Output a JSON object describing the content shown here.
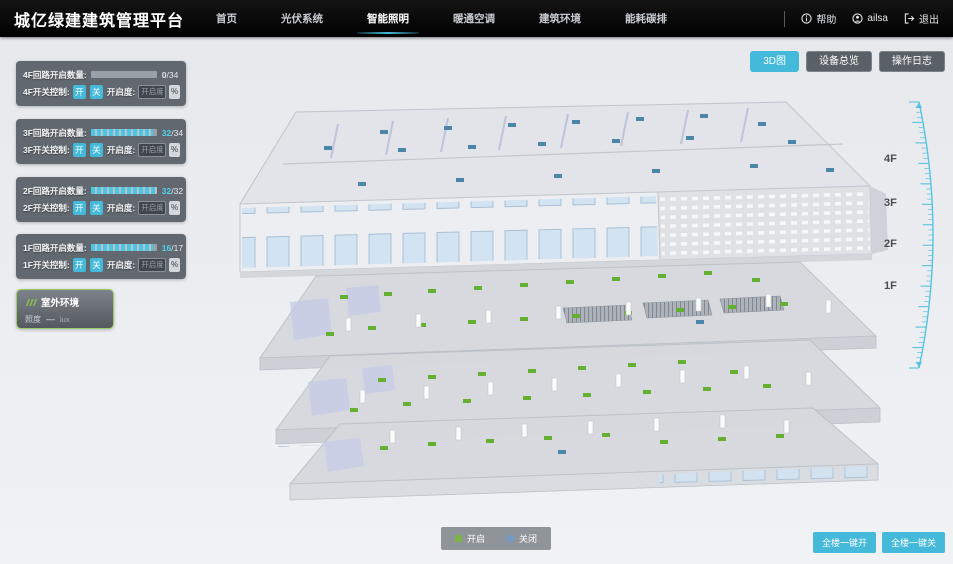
{
  "header": {
    "title": "城亿绿建建筑管理平台",
    "nav": [
      {
        "label": "首页",
        "active": false
      },
      {
        "label": "光伏系统",
        "active": false
      },
      {
        "label": "智能照明",
        "active": true
      },
      {
        "label": "暖通空调",
        "active": false
      },
      {
        "label": "建筑环境",
        "active": false
      },
      {
        "label": "能耗碳排",
        "active": false
      }
    ],
    "user": {
      "help_label": "帮助",
      "username": "ailsa",
      "logout_label": "退出"
    }
  },
  "view_buttons": [
    {
      "label": "3D图",
      "active": true
    },
    {
      "label": "设备总览",
      "active": false
    },
    {
      "label": "操作日志",
      "active": false
    }
  ],
  "floor_panels": [
    {
      "floor": "4F",
      "count_label": "4F回路开启数量:",
      "open": "0",
      "total": "/34",
      "percent": 0,
      "switch_label": "4F开关控制:",
      "on_label": "开",
      "off_label": "关",
      "dim_label": "开启度:",
      "dim_placeholder": "开启度",
      "unit": "%"
    },
    {
      "floor": "3F",
      "count_label": "3F回路开启数量:",
      "open": "32",
      "total": "/34",
      "percent": 94,
      "switch_label": "3F开关控制:",
      "on_label": "开",
      "off_label": "关",
      "dim_label": "开启度:",
      "dim_placeholder": "开启度",
      "unit": "%"
    },
    {
      "floor": "2F",
      "count_label": "2F回路开启数量:",
      "open": "32",
      "total": "/32",
      "percent": 100,
      "switch_label": "2F开关控制:",
      "on_label": "开",
      "off_label": "关",
      "dim_label": "开启度:",
      "dim_placeholder": "开启度",
      "unit": "%"
    },
    {
      "floor": "1F",
      "count_label": "1F回路开启数量:",
      "open": "16",
      "total": "/17",
      "percent": 94,
      "switch_label": "1F开关控制:",
      "on_label": "开",
      "off_label": "关",
      "dim_label": "开启度:",
      "dim_placeholder": "开启度",
      "unit": "%"
    }
  ],
  "outdoor_panel": {
    "title": "室外环境",
    "metric_label": "照度",
    "metric_value": "—",
    "metric_unit": "lux"
  },
  "floor_labels": [
    "4F",
    "3F",
    "2F",
    "1F"
  ],
  "legend": {
    "items": [
      {
        "label": "开启",
        "color": "#7cb342"
      },
      {
        "label": "关闭",
        "color": "#6f9bc4"
      }
    ]
  },
  "bulk_buttons": [
    {
      "label": "全楼一键开"
    },
    {
      "label": "全楼一键关"
    }
  ],
  "colors": {
    "accent": "#45b9d9",
    "marker_on": "#66b031",
    "marker_off": "#4b86a8",
    "outdoor_border": "#9ccc65"
  },
  "building": {
    "colors": {
      "on": "#66b031",
      "off": "#4b86a8",
      "column": "#fbfbfc"
    },
    "items": [
      {
        "t": "off",
        "x": 152,
        "y": 40
      },
      {
        "t": "off",
        "x": 216,
        "y": 36
      },
      {
        "t": "off",
        "x": 280,
        "y": 33
      },
      {
        "t": "off",
        "x": 344,
        "y": 30
      },
      {
        "t": "off",
        "x": 408,
        "y": 27
      },
      {
        "t": "off",
        "x": 472,
        "y": 24
      },
      {
        "t": "off",
        "x": 530,
        "y": 32
      },
      {
        "t": "off",
        "x": 96,
        "y": 56
      },
      {
        "t": "off",
        "x": 170,
        "y": 58
      },
      {
        "t": "off",
        "x": 240,
        "y": 55
      },
      {
        "t": "off",
        "x": 310,
        "y": 52
      },
      {
        "t": "off",
        "x": 384,
        "y": 49
      },
      {
        "t": "off",
        "x": 458,
        "y": 46
      },
      {
        "t": "off",
        "x": 560,
        "y": 50
      },
      {
        "t": "off",
        "x": 130,
        "y": 92
      },
      {
        "t": "off",
        "x": 228,
        "y": 88
      },
      {
        "t": "off",
        "x": 326,
        "y": 84
      },
      {
        "t": "off",
        "x": 424,
        "y": 79
      },
      {
        "t": "off",
        "x": 522,
        "y": 74
      },
      {
        "t": "off",
        "x": 598,
        "y": 78
      },
      {
        "t": "on",
        "x": 112,
        "y": 205
      },
      {
        "t": "on",
        "x": 156,
        "y": 202
      },
      {
        "t": "on",
        "x": 200,
        "y": 199
      },
      {
        "t": "on",
        "x": 246,
        "y": 196
      },
      {
        "t": "on",
        "x": 292,
        "y": 193
      },
      {
        "t": "on",
        "x": 338,
        "y": 190
      },
      {
        "t": "on",
        "x": 384,
        "y": 187
      },
      {
        "t": "on",
        "x": 430,
        "y": 184
      },
      {
        "t": "on",
        "x": 476,
        "y": 181
      },
      {
        "t": "on",
        "x": 524,
        "y": 188
      },
      {
        "t": "on",
        "x": 140,
        "y": 236
      },
      {
        "t": "on",
        "x": 190,
        "y": 233
      },
      {
        "t": "on",
        "x": 240,
        "y": 230
      },
      {
        "t": "on",
        "x": 292,
        "y": 227
      },
      {
        "t": "on",
        "x": 344,
        "y": 224
      },
      {
        "t": "on",
        "x": 396,
        "y": 221
      },
      {
        "t": "on",
        "x": 448,
        "y": 218
      },
      {
        "t": "on",
        "x": 500,
        "y": 215
      },
      {
        "t": "on",
        "x": 552,
        "y": 212
      },
      {
        "t": "on",
        "x": 98,
        "y": 242
      },
      {
        "t": "off",
        "x": 468,
        "y": 230
      },
      {
        "t": "on",
        "x": 150,
        "y": 288
      },
      {
        "t": "on",
        "x": 200,
        "y": 285
      },
      {
        "t": "on",
        "x": 250,
        "y": 282
      },
      {
        "t": "on",
        "x": 300,
        "y": 279
      },
      {
        "t": "on",
        "x": 350,
        "y": 276
      },
      {
        "t": "on",
        "x": 400,
        "y": 273
      },
      {
        "t": "on",
        "x": 450,
        "y": 270
      },
      {
        "t": "on",
        "x": 502,
        "y": 280
      },
      {
        "t": "on",
        "x": 175,
        "y": 312
      },
      {
        "t": "on",
        "x": 235,
        "y": 309
      },
      {
        "t": "on",
        "x": 295,
        "y": 306
      },
      {
        "t": "on",
        "x": 355,
        "y": 303
      },
      {
        "t": "on",
        "x": 415,
        "y": 300
      },
      {
        "t": "on",
        "x": 475,
        "y": 297
      },
      {
        "t": "on",
        "x": 535,
        "y": 294
      },
      {
        "t": "on",
        "x": 122,
        "y": 318
      },
      {
        "t": "on",
        "x": 200,
        "y": 352
      },
      {
        "t": "on",
        "x": 258,
        "y": 349
      },
      {
        "t": "on",
        "x": 316,
        "y": 346
      },
      {
        "t": "on",
        "x": 374,
        "y": 343
      },
      {
        "t": "on",
        "x": 432,
        "y": 350
      },
      {
        "t": "on",
        "x": 490,
        "y": 347
      },
      {
        "t": "on",
        "x": 548,
        "y": 344
      },
      {
        "t": "on",
        "x": 152,
        "y": 356
      },
      {
        "t": "off",
        "x": 330,
        "y": 360
      },
      {
        "t": "col",
        "x": 118,
        "y": 228
      },
      {
        "t": "col",
        "x": 188,
        "y": 224
      },
      {
        "t": "col",
        "x": 258,
        "y": 220
      },
      {
        "t": "col",
        "x": 328,
        "y": 216
      },
      {
        "t": "col",
        "x": 398,
        "y": 212
      },
      {
        "t": "col",
        "x": 468,
        "y": 208
      },
      {
        "t": "col",
        "x": 538,
        "y": 204
      },
      {
        "t": "col",
        "x": 598,
        "y": 210
      },
      {
        "t": "col",
        "x": 132,
        "y": 300
      },
      {
        "t": "col",
        "x": 196,
        "y": 296
      },
      {
        "t": "col",
        "x": 260,
        "y": 292
      },
      {
        "t": "col",
        "x": 324,
        "y": 288
      },
      {
        "t": "col",
        "x": 388,
        "y": 284
      },
      {
        "t": "col",
        "x": 452,
        "y": 280
      },
      {
        "t": "col",
        "x": 516,
        "y": 276
      },
      {
        "t": "col",
        "x": 578,
        "y": 282
      },
      {
        "t": "col",
        "x": 162,
        "y": 340
      },
      {
        "t": "col",
        "x": 228,
        "y": 337
      },
      {
        "t": "col",
        "x": 294,
        "y": 334
      },
      {
        "t": "col",
        "x": 360,
        "y": 331
      },
      {
        "t": "col",
        "x": 426,
        "y": 328
      },
      {
        "t": "col",
        "x": 492,
        "y": 325
      },
      {
        "t": "col",
        "x": 556,
        "y": 330
      }
    ]
  }
}
